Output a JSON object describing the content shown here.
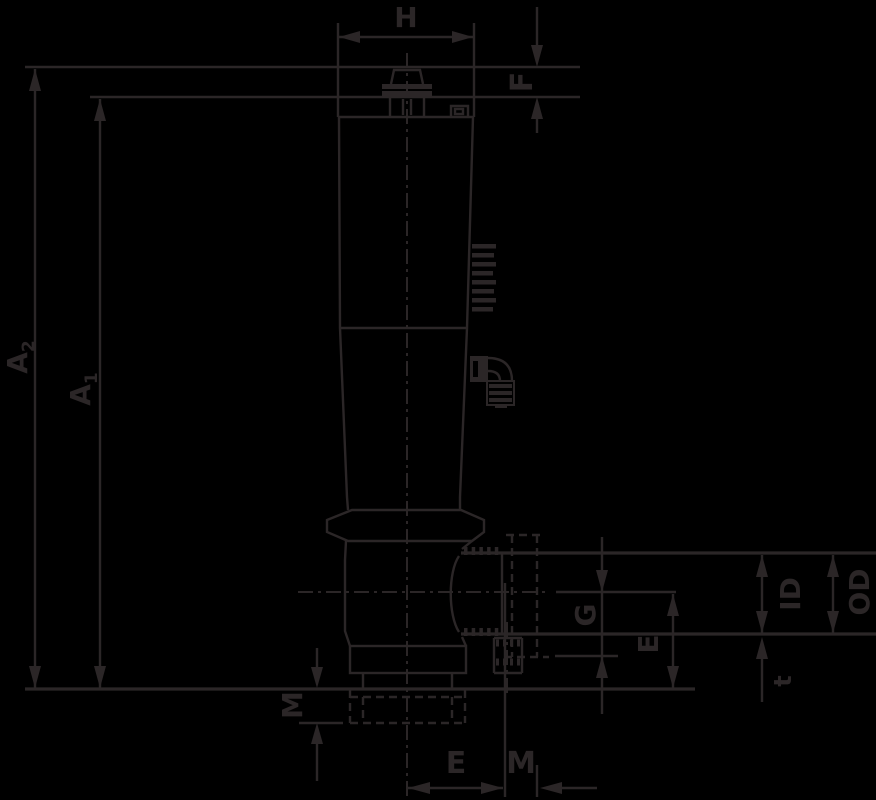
{
  "drawing": {
    "type": "technical-dimension-drawing",
    "background": "#000000",
    "line_color": "#2b2627",
    "dimensions": {
      "H": {
        "label": "H"
      },
      "F": {
        "label": "F"
      },
      "A2": {
        "base": "A",
        "sub": "2"
      },
      "A1": {
        "base": "A",
        "sub": "1"
      },
      "M_left": {
        "label": "M"
      },
      "G": {
        "label": "G"
      },
      "E_right": {
        "label": "E"
      },
      "ID": {
        "label": "ID"
      },
      "OD": {
        "label": "OD"
      },
      "t": {
        "label": "t"
      },
      "E_bottom": {
        "label": "E"
      },
      "M_bottom": {
        "label": "M"
      }
    }
  }
}
